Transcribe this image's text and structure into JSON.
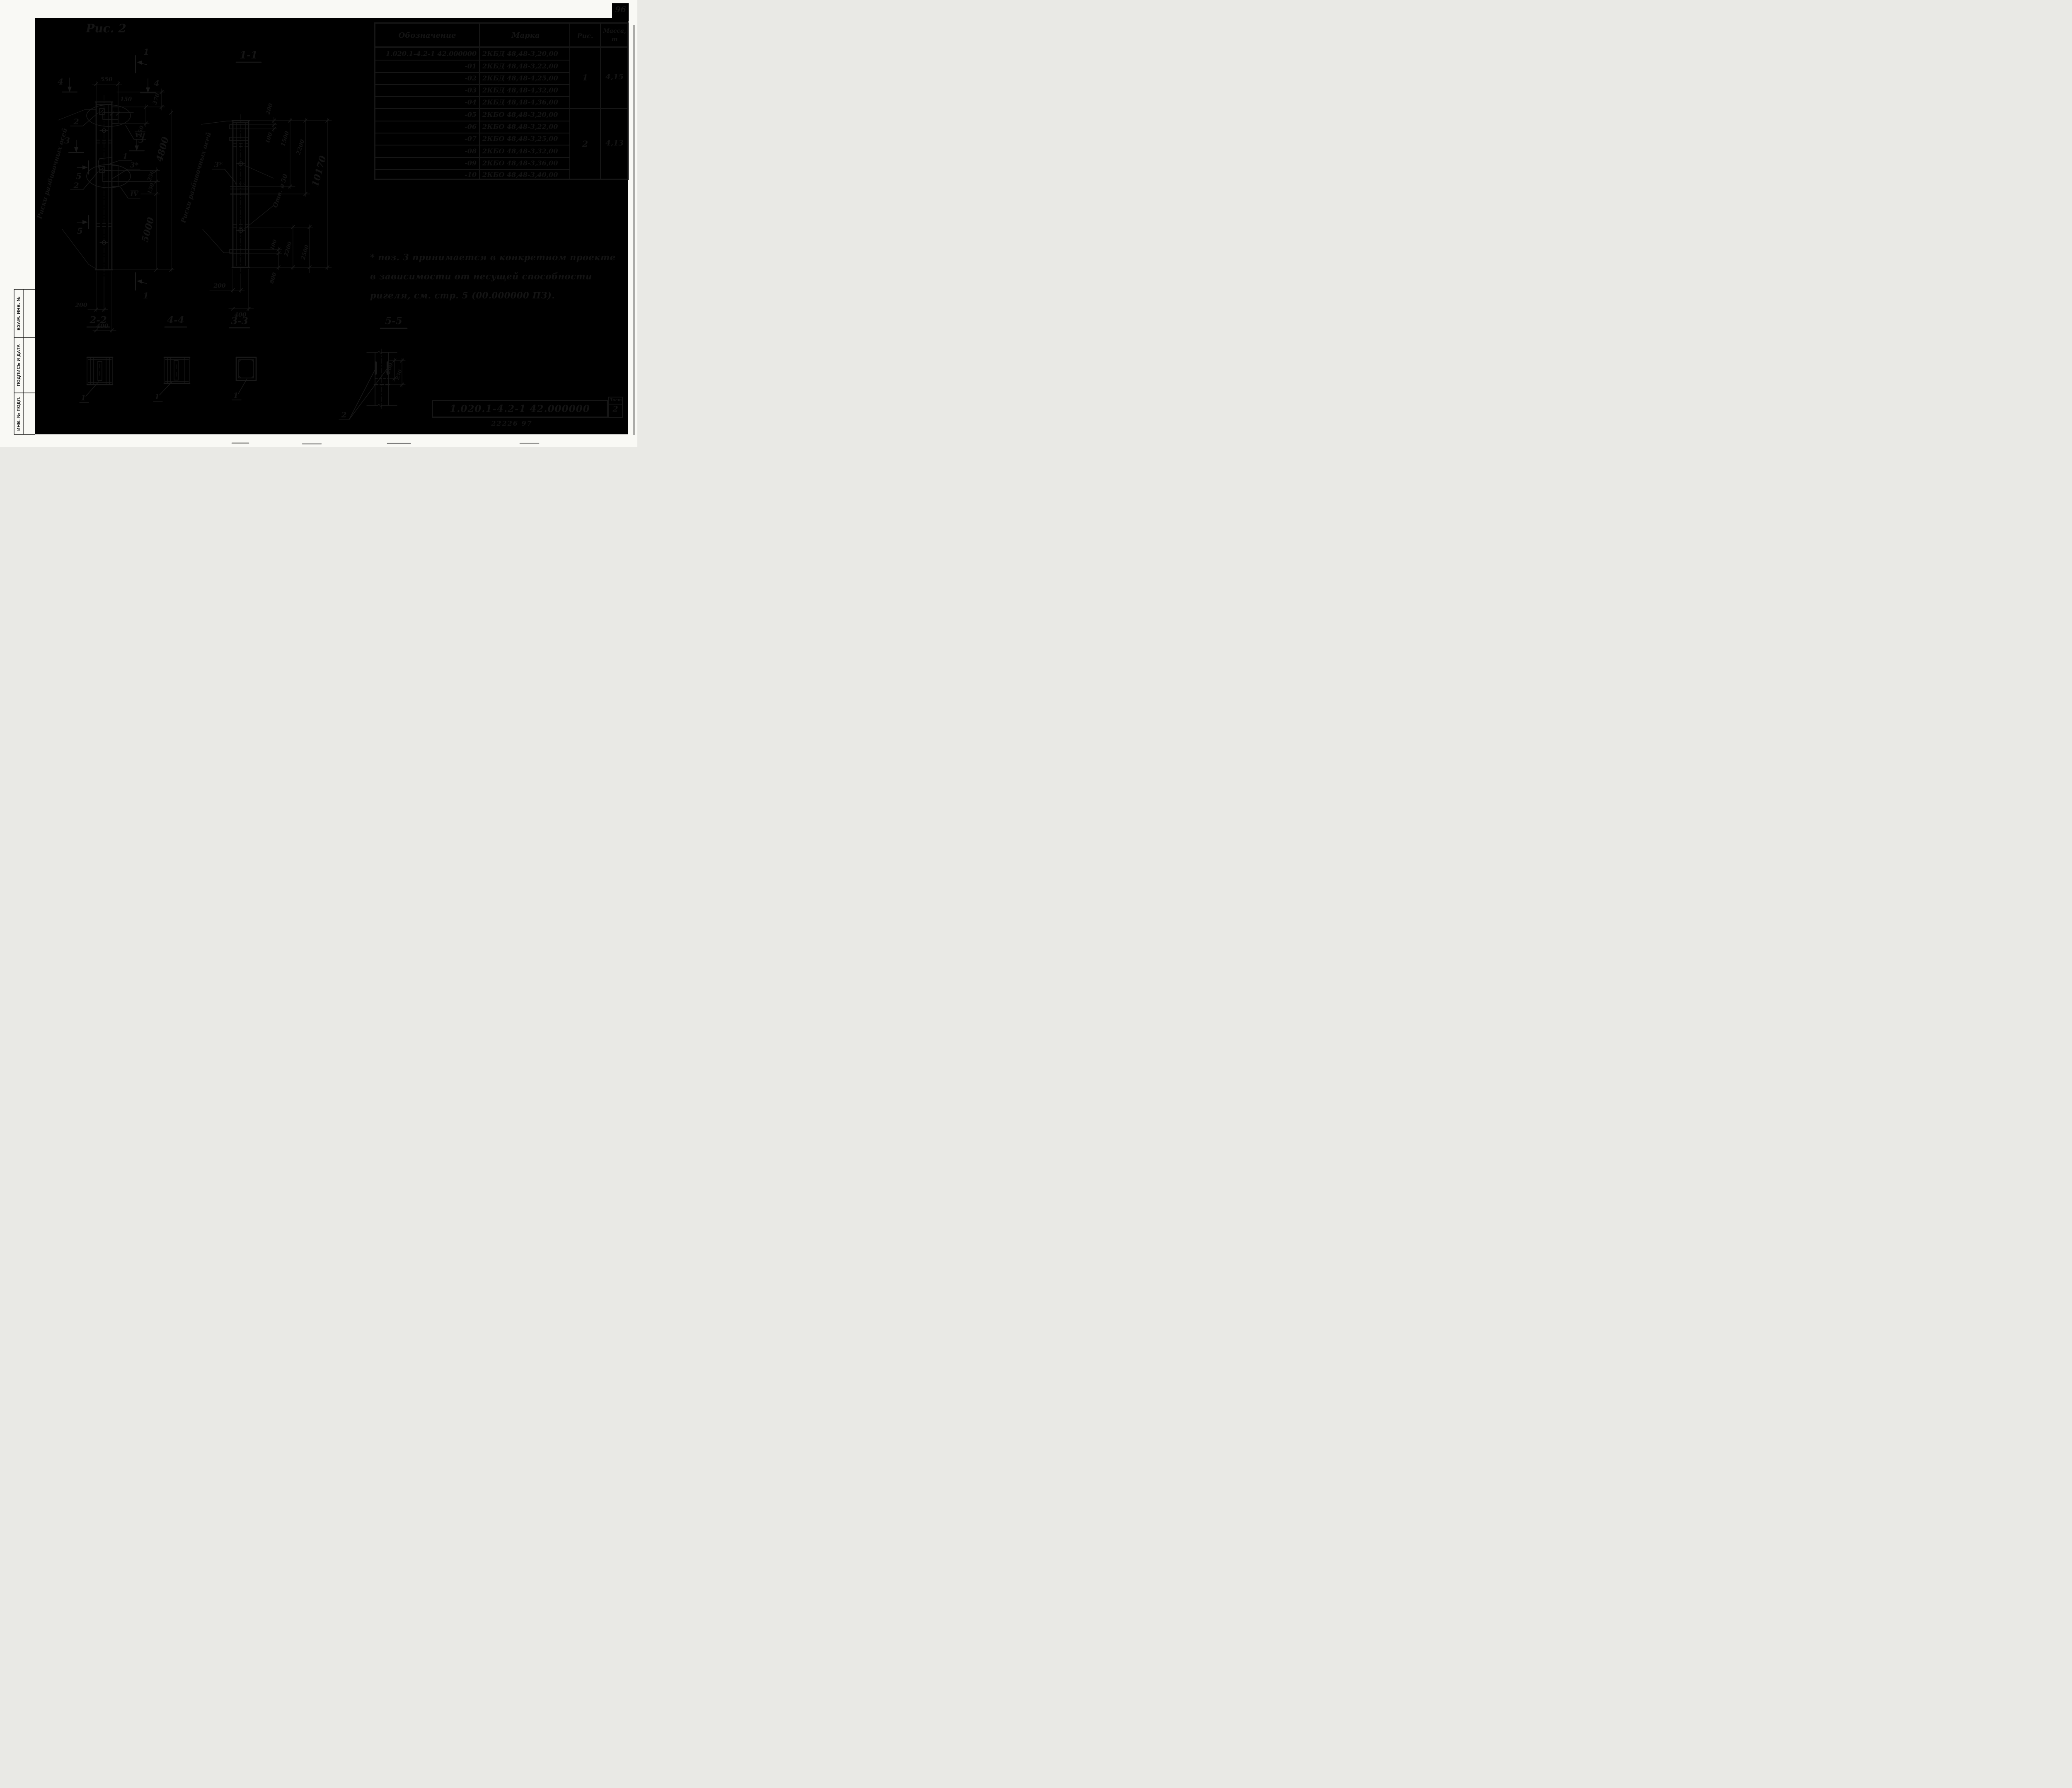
{
  "page": {
    "number": "96"
  },
  "figure_title": "Рис. 2",
  "table": {
    "headers": {
      "designation": "Обозначение",
      "mark": "Марка",
      "fig": "Рис.",
      "mass1": "Масса,",
      "mass2": "т"
    },
    "rows": [
      {
        "designation": "1.020.1-4.2-1  42.000000",
        "mark": "2КБД 48,48-3,20,00"
      },
      {
        "designation": "-01",
        "mark": "2КБД 48,48-3,22,00"
      },
      {
        "designation": "-02",
        "mark": "2КБД 48,48-4,25,00"
      },
      {
        "designation": "-03",
        "mark": "2КБД 48,48-4,32,00"
      },
      {
        "designation": "-04",
        "mark": "2КБД 48,48-4,36,00"
      },
      {
        "designation": "-05",
        "mark": "2КБО 48,48-3,20,00"
      },
      {
        "designation": "-06",
        "mark": "2КБО 48,48-3,22,00"
      },
      {
        "designation": "-07",
        "mark": "2КБО 48,48-3,25,00"
      },
      {
        "designation": "-08",
        "mark": "2КБО 48,48-3,32,00"
      },
      {
        "designation": "-09",
        "mark": "2КБО 48,48-3,36,00"
      },
      {
        "designation": "-10",
        "mark": "2КБО 48,48-3,40,00"
      }
    ],
    "groups": [
      {
        "fig": "1",
        "mass": "4,15"
      },
      {
        "fig": "2",
        "mass": "4,13"
      }
    ]
  },
  "note": {
    "line1": "* поз. 3  принимается в конкретном проекте",
    "line2": "в зависимости от несущей способности",
    "line3": "ригеля, см. стр. 5 (00.000000 ПЗ)."
  },
  "title_block": {
    "designation": "1.020.1-4.2-1  42.000000",
    "sheet_label": "Лист",
    "sheet_number": "2",
    "stamp_code": "22226 97"
  },
  "stamp": {
    "cells": [
      "ВЗАМ. ИНВ. №",
      "ПОДПИСЬ И ДАТА",
      "ИНВ. № ПОДЛ."
    ]
  },
  "front_view": {
    "axis_note": "Риски разбивочных осей",
    "dim_550": "550",
    "dim_150_offset": "150",
    "dim_370": "370",
    "dim_150_vii": "150",
    "dim_250": "250",
    "dim_150_iv": "150",
    "dim_4800": "4800",
    "dim_5000": "5000",
    "dim_200": "200",
    "dim_400": "400",
    "mark_vii": "VII",
    "mark_iv": "IV",
    "pos1": "1",
    "pos2_top": "2",
    "pos2_mid": "2",
    "pos3": "3*",
    "sec1": "1",
    "sec3": "3",
    "sec4": "4",
    "sec5": "5"
  },
  "section_1_1": {
    "title": "1-1",
    "axis_note": "Риски разбивочных осей",
    "hole_label": "Отв. ⌀ 50",
    "dim_200_top": "200",
    "dim_100_top": "100",
    "dim_1500": "1500",
    "dim_2200_top": "2200",
    "dim_10170": "10170",
    "dim_100_bot": "100",
    "dim_2200_bot": "2200",
    "dim_2500": "2500",
    "dim_800": "800",
    "dim_200_bot": "200",
    "dim_400_bot": "400",
    "pos3": "3*"
  },
  "section_2_2": {
    "title": "2-2",
    "pos1": "1"
  },
  "section_4_4": {
    "title": "4-4",
    "pos1": "1"
  },
  "section_3_3": {
    "title": "3-3",
    "pos1": "1"
  },
  "section_5_5": {
    "title": "5-5",
    "pos2": "2",
    "dim_200": "200",
    "dim_250": "250"
  }
}
